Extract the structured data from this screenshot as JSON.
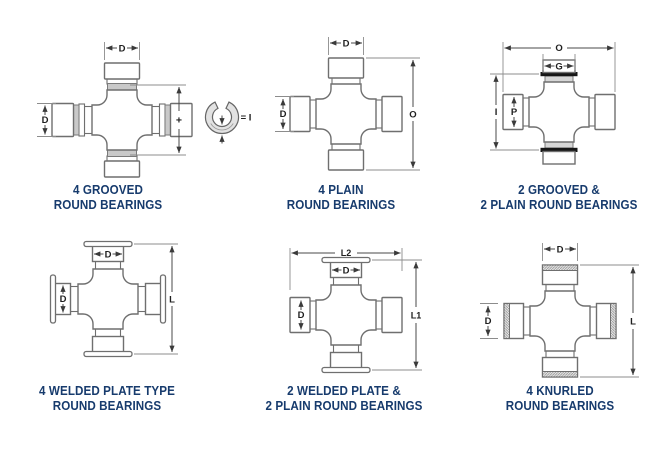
{
  "figure": {
    "background": "#ffffff",
    "caption_color": "#173b6d",
    "line_color": "#6f6f6f",
    "dimension_color": "#3a3a3a",
    "groove_fill": "#c9c9c9",
    "snap_ring_fill": "#e2e2e2",
    "black_ring_fill": "#161616"
  },
  "diagrams": [
    {
      "id": "4-grooved-round-bearings",
      "caption_line1": "4 GROOVED",
      "caption_line2": "ROUND BEARINGS",
      "dims": {
        "top": "D",
        "left": "D",
        "plus": "+",
        "ring_equals": "= I"
      },
      "icons": [
        "snap-ring-icon"
      ]
    },
    {
      "id": "4-plain-round-bearings",
      "caption_line1": "4 PLAIN",
      "caption_line2": "ROUND BEARINGS",
      "dims": {
        "top": "D",
        "left": "D",
        "right": "O"
      }
    },
    {
      "id": "2-grooved-2-plain-round-bearings",
      "caption_line1": "2 GROOVED &",
      "caption_line2": "2 PLAIN ROUND BEARINGS",
      "dims": {
        "outer_width": "O",
        "cap_width": "G",
        "outer_height": "I",
        "cap_bore": "P"
      }
    },
    {
      "id": "4-welded-plate-type-round-bearings",
      "caption_line1": "4 WELDED PLATE TYPE",
      "caption_line2": "ROUND BEARINGS",
      "dims": {
        "top": "D",
        "left": "D",
        "right": "L"
      }
    },
    {
      "id": "2-welded-plate-2-plain-round-bearings",
      "caption_line1": "2 WELDED PLATE &",
      "caption_line2": "2 PLAIN ROUND BEARINGS",
      "dims": {
        "outer_width": "L2",
        "top": "D",
        "left": "D",
        "right": "L1"
      }
    },
    {
      "id": "4-knurled-round-bearings",
      "caption_line1": "4 KNURLED",
      "caption_line2": "ROUND BEARINGS",
      "dims": {
        "top": "D",
        "left": "D",
        "right": "L"
      }
    }
  ]
}
